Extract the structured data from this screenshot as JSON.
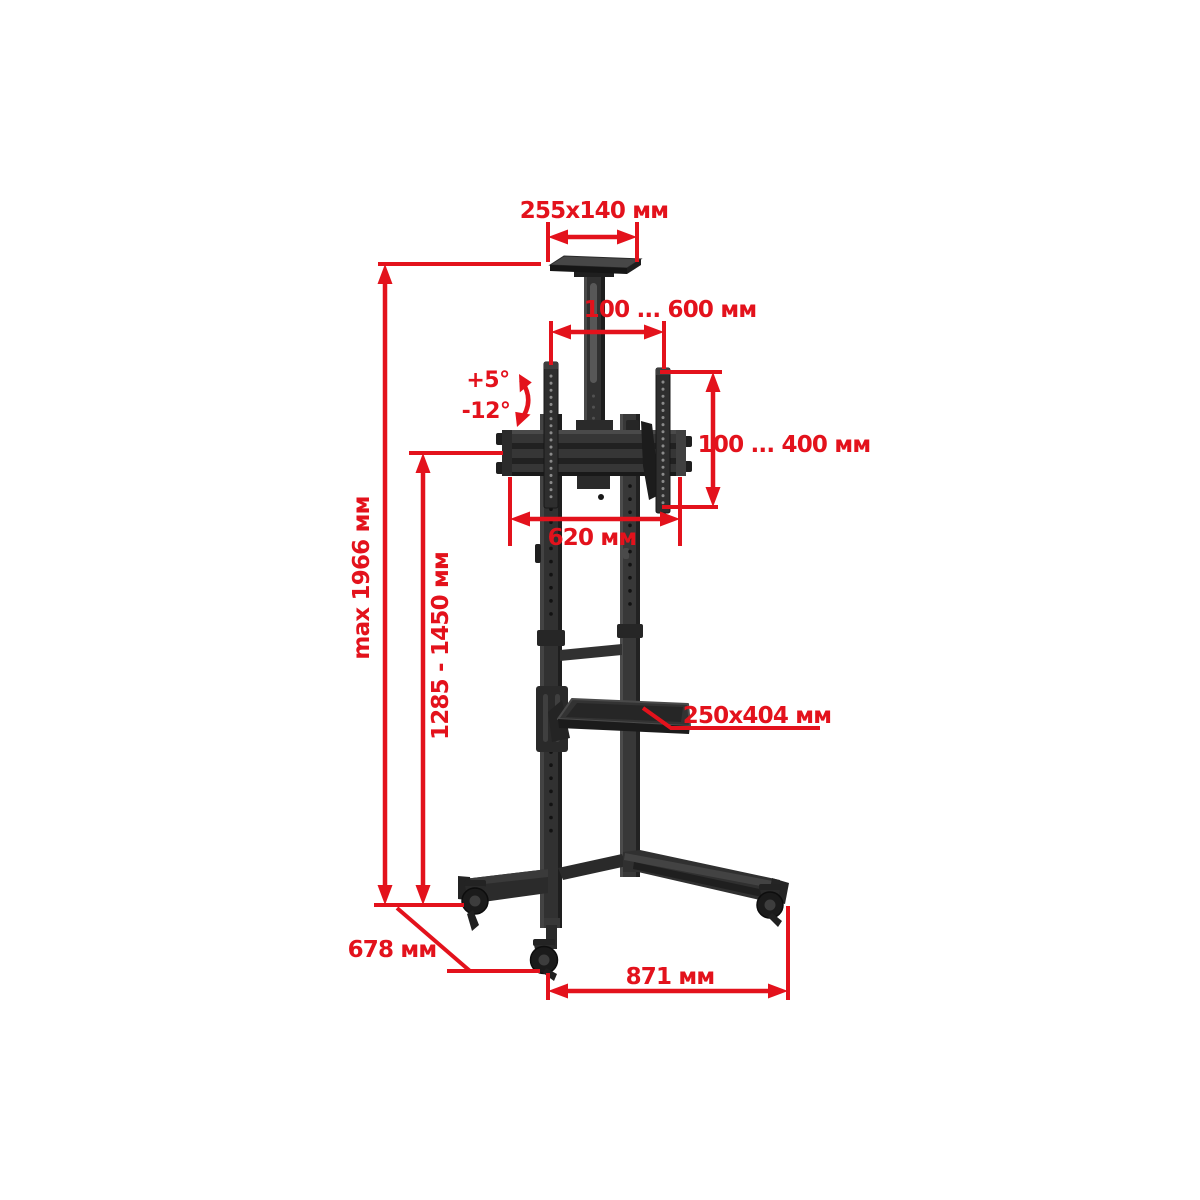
{
  "page": {
    "background": "#ffffff",
    "accent_color": "#e3121c",
    "product_color": "#2e2e2e",
    "unit": "мм"
  },
  "diagram": {
    "subject": "mobile-tv-stand-dimensions",
    "labels": {
      "top_shelf_size": "255x140 мм",
      "vesa_width_range": "100 ... 600 мм",
      "tilt_up": "+5°",
      "tilt_down": "-12°",
      "vesa_height_range": "100 ... 400 мм",
      "bracket_width": "620 мм",
      "max_height": "max 1966 мм",
      "column_height_range": "1285 - 1450 мм",
      "shelf_size": "250x404 мм",
      "base_depth": "678 мм",
      "base_width": "871 мм"
    }
  }
}
